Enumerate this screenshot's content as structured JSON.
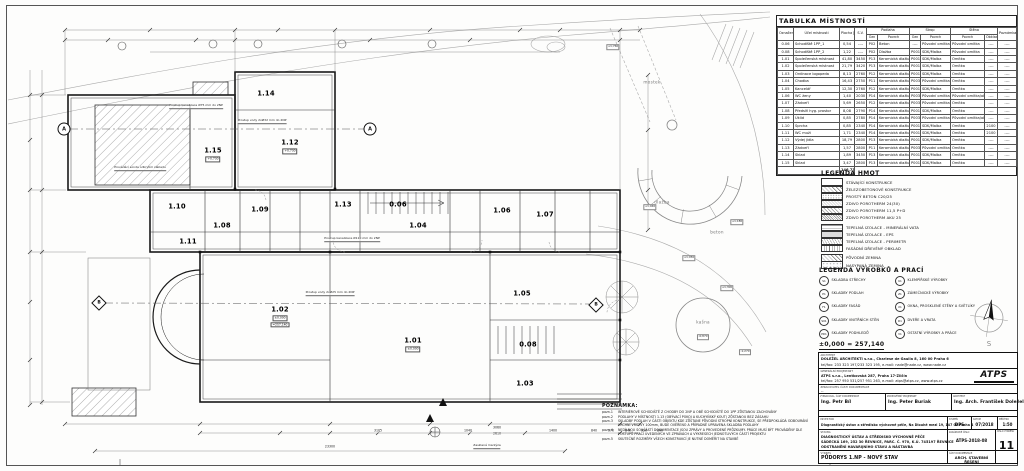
{
  "room_table": {
    "title": "TABULKA MÍSTNOSTÍ",
    "groups": {
      "podlaha": "Podlaha",
      "strop": "Strop",
      "stena": "Stěna"
    },
    "columns": [
      "Označení na výkresu",
      "Účel místnosti",
      "Plocha [m²]",
      "S.V.",
      "Ozn",
      "Povrch",
      "Ozn",
      "Povrch",
      "Povrch",
      "Obklad",
      "Poznámka"
    ],
    "rows": [
      [
        "0.06",
        "Schodiště 1PP_1",
        "0,54",
        "----",
        "P02",
        "Beton",
        "----",
        "Původní omítka",
        "Původní omítka",
        "----",
        "----"
      ],
      [
        "0.08",
        "Schodiště 1PP_2",
        "1,22",
        "----",
        "P02",
        "Dlažba",
        "P001",
        "SDK/Malba",
        "Původní omítka",
        "----",
        "----"
      ],
      [
        "1.01",
        "Společenská místnost",
        "41,80",
        "3450",
        "P13",
        "Keramická dlažba",
        "P001",
        "SDK/Malba",
        "Omítka",
        "----",
        "----"
      ],
      [
        "1.02",
        "Společenská místnost",
        "21,79",
        "3420",
        "P13",
        "Keramická dlažba",
        "P001",
        "SDK/Malba",
        "Omítka",
        "----",
        "----"
      ],
      [
        "1.03",
        "Ordinace logopeda",
        "8,13",
        "2760",
        "P12",
        "Keramická dlažba",
        "P001",
        "SDK/Malba",
        "Omítka",
        "----",
        "----"
      ],
      [
        "1.04",
        "Chodba",
        "16,43",
        "2750",
        "P11",
        "Keramická dlažba",
        "P003",
        "Původní omítka",
        "Omítka",
        "----",
        "----"
      ],
      [
        "1.05",
        "Kancelář",
        "12,30",
        "2760",
        "P12",
        "Keramická dlažba",
        "P001",
        "SDK/Malba",
        "Omítka",
        "----",
        "----"
      ],
      [
        "1.06",
        "WC ženy",
        "1,40",
        "2030",
        "P14",
        "Keramická dlažba",
        "P003",
        "Původní omítka",
        "Původní omítka/obklad",
        "----",
        "----"
      ],
      [
        "1.07",
        "Zádveří",
        "5,69",
        "2650",
        "P12",
        "Keramická dlažba",
        "P003",
        "Původní omítka",
        "Omítka",
        "----",
        "----"
      ],
      [
        "1.08",
        "Předsíň hyg. prostor",
        "8,08",
        "2790",
        "P14",
        "Keramická dlažba",
        "P001",
        "SDK/Malba",
        "Omítka",
        "----",
        "----"
      ],
      [
        "1.09",
        "Úklid",
        "0,85",
        "2780",
        "P14",
        "Keramická dlažba",
        "P003",
        "Původní omítka",
        "Původní omítka/obklad",
        "----",
        "----"
      ],
      [
        "1.10",
        "Sprcha",
        "0,85",
        "2340",
        "P14",
        "Keramická dlažba",
        "P001",
        "SDK/Malba",
        "Omítka",
        "2100",
        "----"
      ],
      [
        "1.11",
        "WC muži",
        "1,71",
        "2340",
        "P14",
        "Keramická dlažba",
        "P001",
        "SDK/Malba",
        "Omítka",
        "2100",
        "----"
      ],
      [
        "1.12",
        "Výdej jídla",
        "18,79",
        "2800",
        "P13",
        "Keramická dlažba",
        "P001",
        "SDK/Malba",
        "Omítka",
        "----",
        "----"
      ],
      [
        "1.13",
        "Zádveří",
        "1,57",
        "2800",
        "P11",
        "Keramická dlažba",
        "P003",
        "Původní omítka",
        "Omítka",
        "----",
        "----"
      ],
      [
        "1.14",
        "Sklad",
        "1,89",
        "3450",
        "P13",
        "Keramická dlažba",
        "P001",
        "SDK/Malba",
        "Omítka",
        "----",
        "----"
      ],
      [
        "1.15",
        "Sklad",
        "3,47",
        "2800",
        "P13",
        "Keramická dlažba",
        "P001",
        "SDK/Malba",
        "Omítka",
        "----",
        "----"
      ]
    ],
    "total": "146,73"
  },
  "legend_hmot": {
    "title": "LEGENDA HMOT",
    "items": [
      {
        "label": "STÁVAJÍCÍ KONSTRUKCE",
        "pattern": "plain",
        "gap": false
      },
      {
        "label": "ŽELEZOBETONOVÉ KONSTRUKCE",
        "pattern": "diag",
        "gap": false
      },
      {
        "label": "PROSTÝ BETON C20/25",
        "pattern": "dots",
        "gap": false
      },
      {
        "label": "ZDIVO POROTHERM 24(30)",
        "pattern": "diag-fine",
        "gap": false
      },
      {
        "label": "ZDIVO POROTHERM 11,5 P+D",
        "pattern": "cross",
        "gap": false
      },
      {
        "label": "ZDIVO POROTHERM AKU 25",
        "pattern": "diag-dense",
        "gap": false
      },
      {
        "label": "TEPELNÁ IZOLACE - MINERÁLNÍ VATA",
        "pattern": "wave",
        "gap": true
      },
      {
        "label": "TEPELNÁ IZOLACE - EPS",
        "pattern": "gray",
        "gap": false
      },
      {
        "label": "TEPELNÁ IZOLACE - PERIMETR",
        "pattern": "zigzag",
        "gap": false
      },
      {
        "label": "FASÁDNÍ DŘEVĚNÝ OBKLAD",
        "pattern": "vert",
        "gap": false
      },
      {
        "label": "PŮVODNÍ ZEMINA",
        "pattern": "diag",
        "gap": true
      },
      {
        "label": "NASYPANÁ ZEMINA",
        "pattern": "dots-light",
        "gap": false
      }
    ]
  },
  "legend_vyrobky": {
    "title": "LEGENDA VÝROBKŮ A PRACÍ",
    "left": [
      {
        "code": "S1",
        "label": "SKLADBA STŘECHY"
      },
      {
        "code": "P1",
        "label": "SKLADBY PODLAH"
      },
      {
        "code": "F1",
        "label": "SKLADBY FASÁD"
      },
      {
        "code": "S01",
        "label": "SKLADBY VNITŘNÍCH STĚN"
      },
      {
        "code": "PD1",
        "label": "SKLADBY PODHLEDŮ"
      }
    ],
    "right": [
      {
        "code": "K1",
        "label": "KLEMPÍŘSKÉ VÝROBKY"
      },
      {
        "code": "Z1",
        "label": "ZÁMEČNICKÉ VÝROBKY"
      },
      {
        "code": "X1",
        "label": "OKNA, PROSKLENÉ STĚNY A SVĚTLÍKY"
      },
      {
        "code": "D1",
        "label": "DVEŘE A VRATA"
      },
      {
        "code": "V1",
        "label": "OSTATNÍ VÝROBKY A PRÁCE"
      }
    ]
  },
  "elevation_note": "±0,000 = 257,140",
  "compass": {
    "south_label": "S"
  },
  "notes": {
    "title": "POZNÁMKA:",
    "items": [
      {
        "num": "pozn.1",
        "text": "INTERIÉROVÉ SCHODIŠTĚ Z CHODBY DO 2NP A OBĚ SCHODIŠTĚ DO 1PP ZŮSTANOU ZACHOVÁNY"
      },
      {
        "num": "pozn.2",
        "text": "PODLAHY V MÍSTNOSTI 1.13 (OBÝVACÍ POKOJ A KUCHYŇSKÝ KOUT) ZŮSTANOU BEZ ZÁSAHU"
      },
      {
        "num": "pozn.3",
        "text": "SKLADBY PODLAH V ČÁSTI OBJEKTU KDE ZŮSTANE PŮVODNÍ STROPNÍ KONSTRUKCE, SE PŘEDPOKLÁDÁ ODBOURÁNÍ VRCHNÍ VRSTVY 100mm, BUDE OVĚŘENO A PŘÍPADNĚ UPRAVENA SKLADBA PODLAHY"
      },
      {
        "num": "pozn.4",
        "text": "NEDÍLNOU SOUČÁSTÍ DOKUMENTACE JSOU ZPRÁVY A PROVEDENÉ PRŮZKUMY. PRÁCE MUSÍ BÝT PROVÁDĚNY DLE POSTUPŮ PRACÍ UVEDENÝCH VE ZPRÁVÁCH A VÝKRESECH JEDNOTLIVÝCH ČÁSTÍ PROJEKTU"
      },
      {
        "num": "pozn.5",
        "text": "SKUTEČNÉ ROZMĚRY VŠECH KONSTRUKCÍ JE NUTNÉ DOMĚŘIT NA STAVBĚ"
      }
    ]
  },
  "title_block": {
    "architect_office": {
      "label": "ARCHITEKT",
      "line1": "DOLEŽEL ARCHITEKTI s.r.o., Charlese de Gaulla 8, 160 00 Praha 6",
      "line2": "tel/fax: 233 323 197/233 323 195, e-mail: nade@nade.cz, www.nade.cz"
    },
    "general_designer": {
      "label": "GENERÁLNÍ PROJEKTANT",
      "line1": "ATPS s.r.o., Lentkovská 287, Praha 17-Zličín",
      "line2": "tel/fax: 257 950 531/257 951 263, e-mail: atps@atps.cz, www.atps.cz",
      "logo": "ATPS"
    },
    "doc_part_author": {
      "label": "ZPRACOVATEL ČÁSTI DOKUMENTACE",
      "value": "--"
    },
    "people": [
      {
        "label": "VYPRACOVAL, ČÁST DOKUMENTACE",
        "name": "Ing. Petr Bíl"
      },
      {
        "label": "ZODPOVĚDNÝ PROJEKTANT",
        "name": "Ing. Peter Buriak"
      },
      {
        "label": "ARCHITEKT",
        "name": "Ing. Arch. František Doležel"
      }
    ],
    "investor": {
      "label": "INVESTOR",
      "value": "Diagnostický ústav a středisko výchovné péče, Na Dlouhé mezi 19, 147 00 Praha 4"
    },
    "stavba": {
      "label": "STAVBA",
      "lines": [
        "DIAGNOSTICKÝ ÚSTAV A STŘEDISKO VÝCHOVNÉ PÉČE",
        "SÁDECKÁ 169, 252 30 ŘEVNICE, PARC. Č. 970, K.Ú. 745197 ŘEVNICE",
        "ODSTRANĚNÍ HAVARIJNÍHO STAVU A NÁSTAVBA"
      ]
    },
    "vykres": {
      "label": "VÝKRES",
      "value": "PŮDORYS 1.NP - NOVÝ STAV"
    },
    "stupen": {
      "label": "STUPEŇ",
      "value": "DPS"
    },
    "datum": {
      "label": "DATUM",
      "value": "07/2018"
    },
    "meritko": {
      "label": "MĚŘÍTKO",
      "value": "1:50"
    },
    "zakazka": {
      "label": "ZAKÁZKOVÉ ČÍSLO",
      "value": "ATPS-2018-08"
    },
    "cislo": {
      "label": "ČÍSLO VÝKRESU",
      "value": "11"
    },
    "cast": {
      "label": "ČÁST DOKUMENTACE",
      "value": "ARCH. STAVEBNÍ ŘEŠENÍ"
    }
  },
  "plan": {
    "rooms": [
      {
        "id": "1.15",
        "x": 213,
        "y": 150,
        "sub": [
          "+0,730"
        ]
      },
      {
        "id": "1.14",
        "x": 266,
        "y": 90
      },
      {
        "id": "1.12",
        "x": 290,
        "y": 142,
        "sub": [
          "+0,730"
        ]
      },
      {
        "id": "1.10",
        "x": 177,
        "y": 203
      },
      {
        "id": "1.11",
        "x": 188,
        "y": 238
      },
      {
        "id": "1.08",
        "x": 222,
        "y": 222
      },
      {
        "id": "1.09",
        "x": 260,
        "y": 206
      },
      {
        "id": "1.13",
        "x": 343,
        "y": 201
      },
      {
        "id": "0.06",
        "x": 398,
        "y": 201
      },
      {
        "id": "1.04",
        "x": 418,
        "y": 222
      },
      {
        "id": "1.06",
        "x": 502,
        "y": 207
      },
      {
        "id": "1.07",
        "x": 545,
        "y": 211
      },
      {
        "id": "1.02",
        "x": 280,
        "y": 312,
        "sub": [
          "±0,000",
          "=257,140"
        ]
      },
      {
        "id": "1.01",
        "x": 413,
        "y": 340,
        "sub": [
          "±0,000"
        ]
      },
      {
        "id": "1.05",
        "x": 522,
        "y": 290
      },
      {
        "id": "0.08",
        "x": 528,
        "y": 341
      },
      {
        "id": "1.03",
        "x": 525,
        "y": 380
      }
    ],
    "site_labels": [
      {
        "t": "mostek",
        "x": 652,
        "y": 82
      },
      {
        "t": "dlažba",
        "x": 662,
        "y": 202
      },
      {
        "t": "beton",
        "x": 717,
        "y": 232
      },
      {
        "t": "kašna",
        "x": 703,
        "y": 322
      }
    ],
    "elevation_labels": [
      {
        "t": "+1,760",
        "x": 613,
        "y": 47
      },
      {
        "t": "+1,040",
        "x": 650,
        "y": 207
      },
      {
        "t": "+1,180",
        "x": 737,
        "y": 222
      },
      {
        "t": "+1,050",
        "x": 689,
        "y": 258
      },
      {
        "t": "+1,300",
        "x": 727,
        "y": 288
      },
      {
        "t": "-0,870",
        "x": 703,
        "y": 337
      },
      {
        "t": "-1,270",
        "x": 745,
        "y": 352
      }
    ],
    "leader_labels": [
      {
        "t": "Prováděcí sonda odkrytím základu",
        "x": 140,
        "y": 171
      },
      {
        "t": "Prostup kanalizace Ø75 mm do 2NP",
        "x": 196,
        "y": 109
      },
      {
        "t": "Prostup vody 2xØ32 mm do 2NP",
        "x": 262,
        "y": 124
      },
      {
        "t": "Prostup kanalizace Ø110 mm do 2NP",
        "x": 352,
        "y": 242
      },
      {
        "t": "Prostup vody 2xØ25 mm do 2NP",
        "x": 330,
        "y": 296
      },
      {
        "t": "Zasklená markýza",
        "x": 487,
        "y": 449
      }
    ],
    "dims": [
      {
        "t": "3105",
        "x": 378,
        "y": 433
      },
      {
        "t": "1040",
        "x": 468,
        "y": 433
      },
      {
        "t": "3060",
        "x": 497,
        "y": 430
      },
      {
        "t": "2610",
        "x": 497,
        "y": 436
      },
      {
        "t": "1400",
        "x": 553,
        "y": 433
      },
      {
        "t": "840",
        "x": 594,
        "y": 433
      },
      {
        "t": "370",
        "x": 611,
        "y": 433
      },
      {
        "t": "840",
        "x": 628,
        "y": 433
      },
      {
        "t": "330",
        "x": 644,
        "y": 433
      },
      {
        "t": "840",
        "x": 660,
        "y": 433
      },
      {
        "t": "23300",
        "x": 330,
        "y": 449
      }
    ],
    "axis_circles": [
      {
        "label": "A",
        "x": 64,
        "y": 129
      },
      {
        "label": "A",
        "x": 370,
        "y": 129
      }
    ],
    "axis_diamonds": [
      {
        "label": "B",
        "x": 99,
        "y": 303
      },
      {
        "label": "B",
        "x": 596,
        "y": 305
      }
    ]
  }
}
